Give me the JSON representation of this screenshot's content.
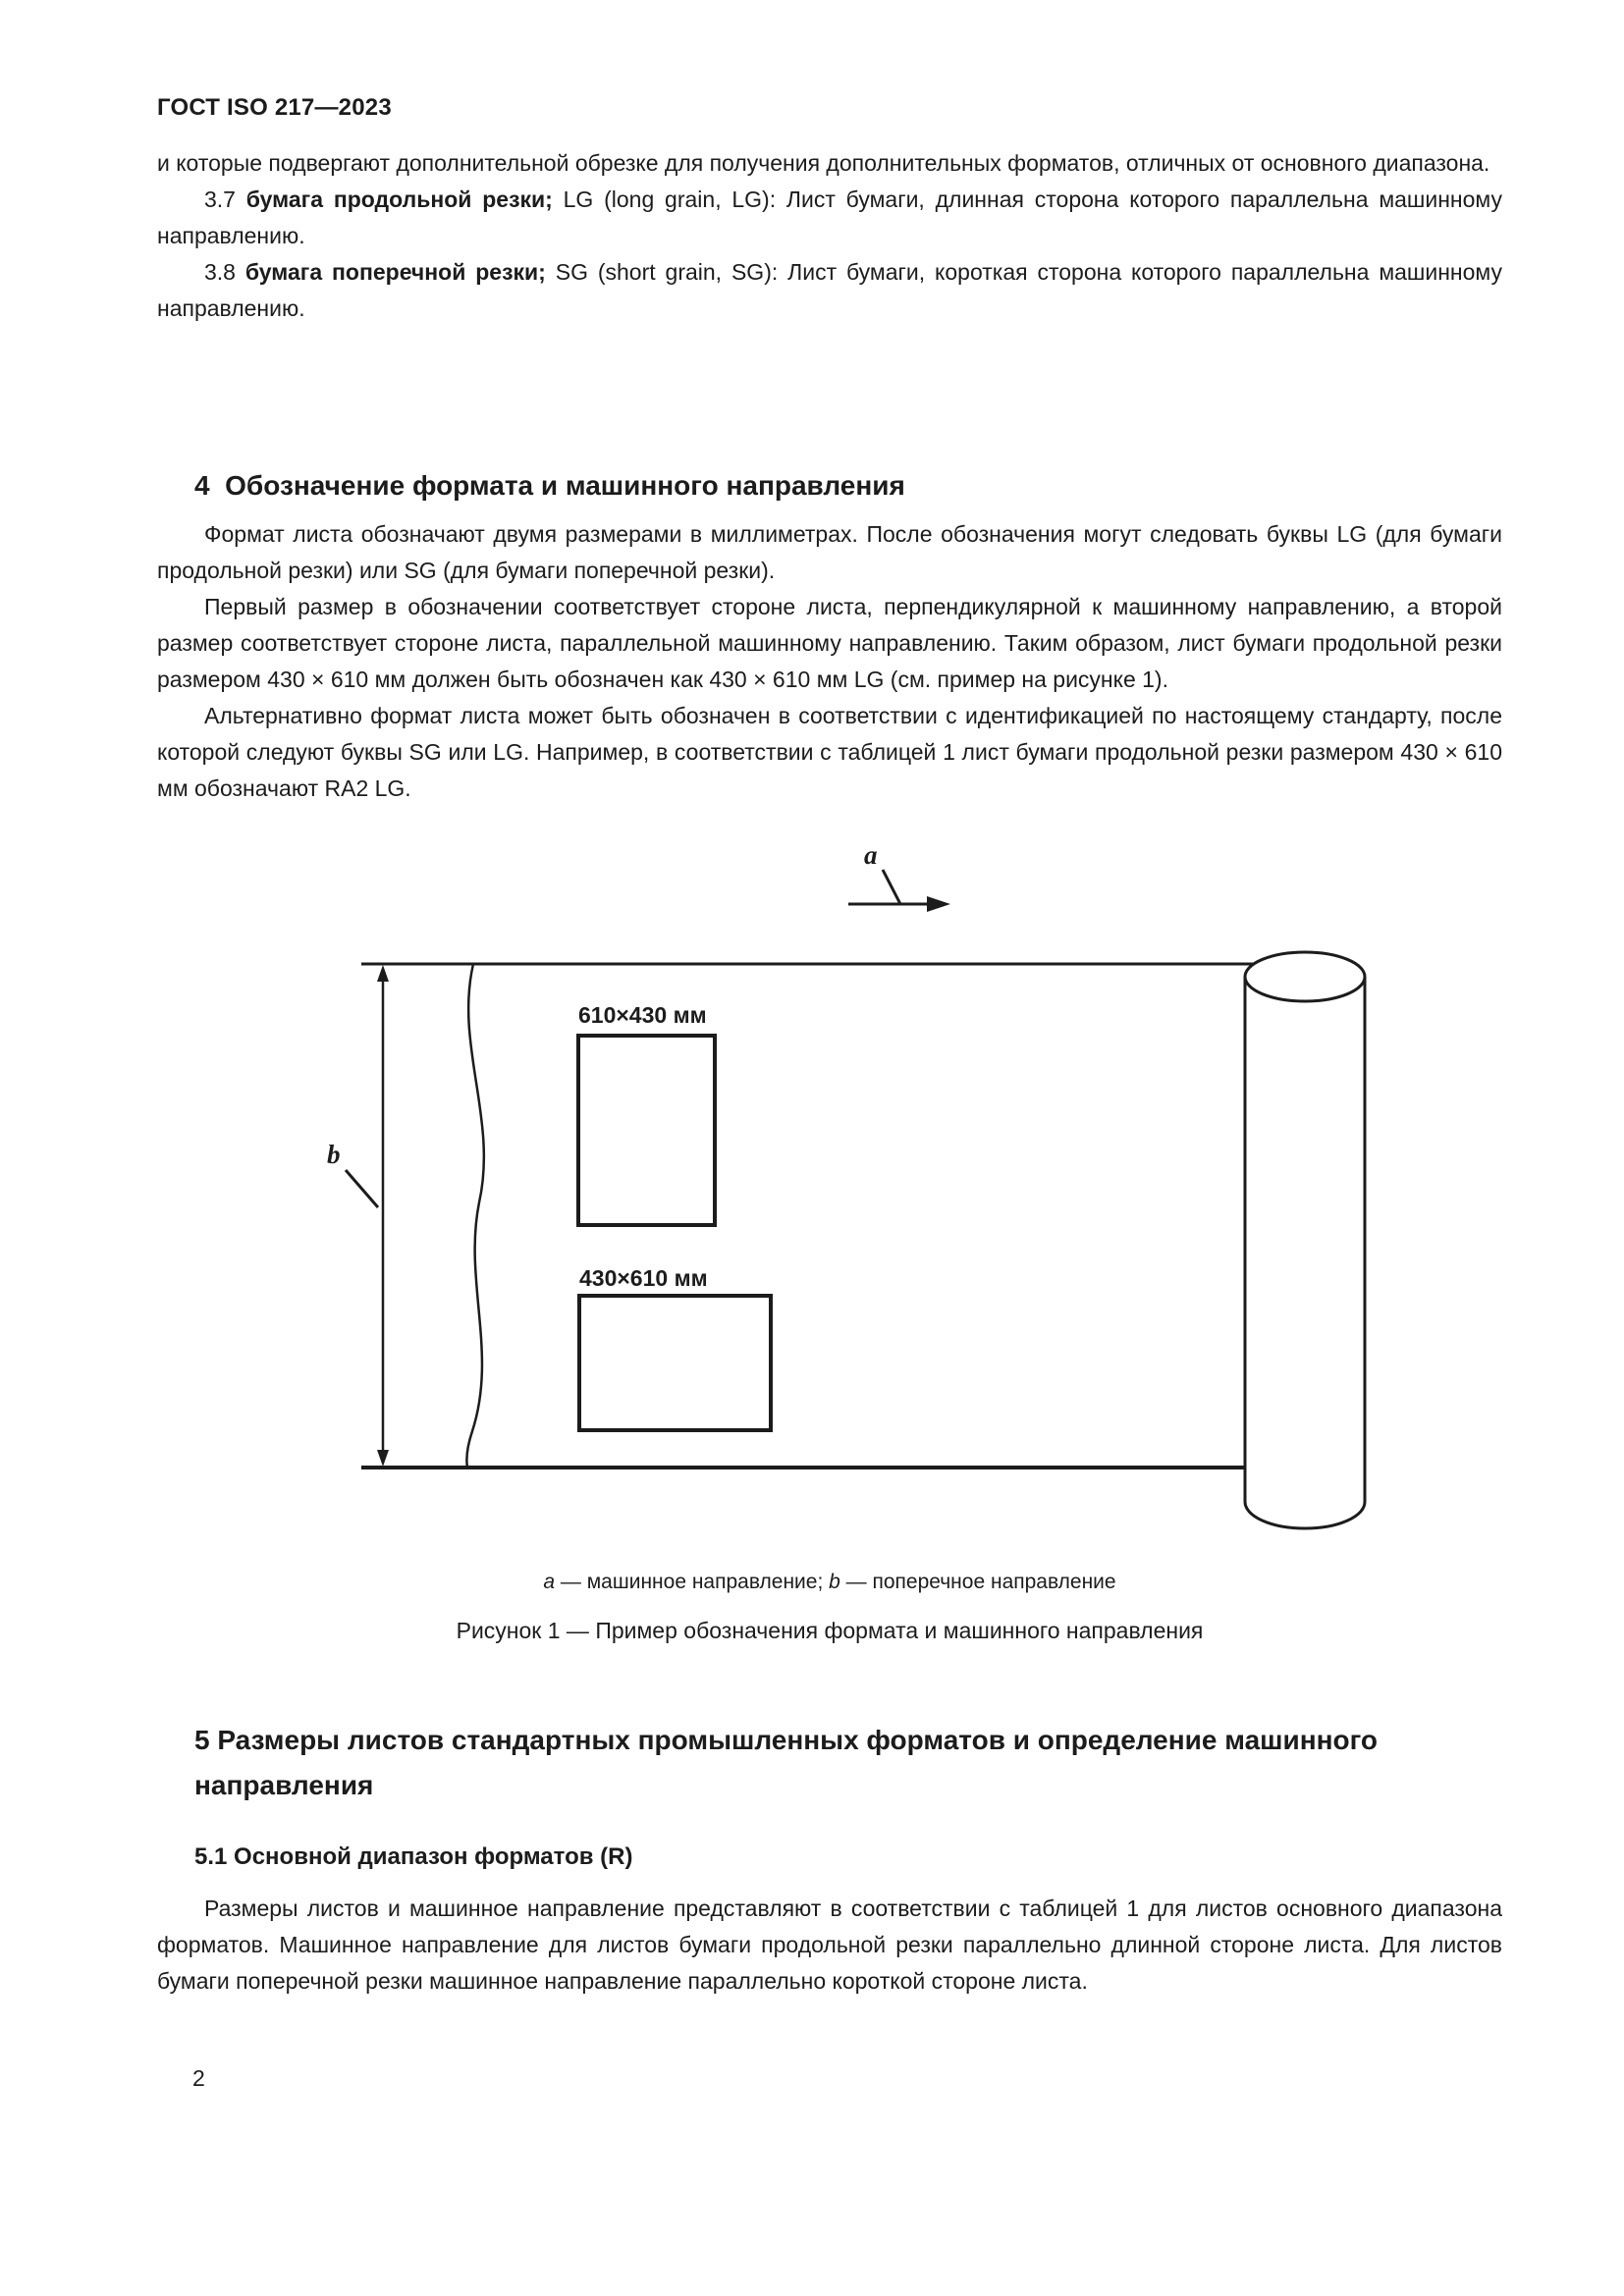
{
  "header": {
    "title": "ГОСТ ISO 217—2023"
  },
  "content": {
    "p_intro": "и которые подвергают дополнительной обрезке для получения дополнительных форматов, отличных от основного диапазона.",
    "p37": {
      "num": "3.7 ",
      "term": "бумага продольной резки;",
      "rest": " LG (long grain, LG): Лист бумаги, длинная сторона которого параллельна машинному направлению."
    },
    "p38": {
      "num": "3.8 ",
      "term": "бумага поперечной резки;",
      "rest": " SG (short grain, SG): Лист бумаги, короткая сторона которого параллельна машинному направлению."
    },
    "h4": "4  Обозначение формата и машинного направления",
    "p4_1": "Формат листа обозначают двумя размерами в миллиметрах. После обозначения могут следовать буквы LG (для бумаги продольной резки) или SG (для бумаги поперечной резки).",
    "p4_2": "Первый размер в обозначении соответствует стороне листа, перпендикулярной к машинному направлению, а второй размер соответствует стороне листа, параллельной машинному направлению. Таким образом, лист бумаги продольной резки размером 430 × 610 мм должен быть обозначен как 430 × 610 мм LG (см. пример на рисунке 1).",
    "p4_3": "Альтернативно формат листа может быть обозначен в соответствии с идентификацией по настоящему стандарту, после которой следуют буквы SG или LG. Например, в соответствии с таблицей 1 лист бумаги продольной резки размером 430 × 610 мм обозначают RA2 LG.",
    "h5": "5 Размеры листов стандартных промышленных форматов и определение машинного направления",
    "h51": "5.1 Основной диапазон форматов (R)",
    "p5_1": "Размеры листов и машинное направление представляют в соответствии с таблицей 1 для листов основного диапазона форматов. Машинное направление для листов бумаги продольной резки параллельно длинной стороне листа. Для листов бумаги поперечной резки машинное направление параллельно короткой стороне листа."
  },
  "figure": {
    "label_a": "a",
    "label_b": "b",
    "sheet_portrait_label": "610×430 мм",
    "sheet_landscape_label": "430×610 мм",
    "legend": {
      "a": "a",
      "a_text": " — машинное направление; ",
      "b": "b",
      "b_text": " — поперечное направление"
    },
    "caption": "Рисунок 1 — Пример обозначения формата и машинного направления"
  },
  "footer": {
    "page_number": "2"
  }
}
